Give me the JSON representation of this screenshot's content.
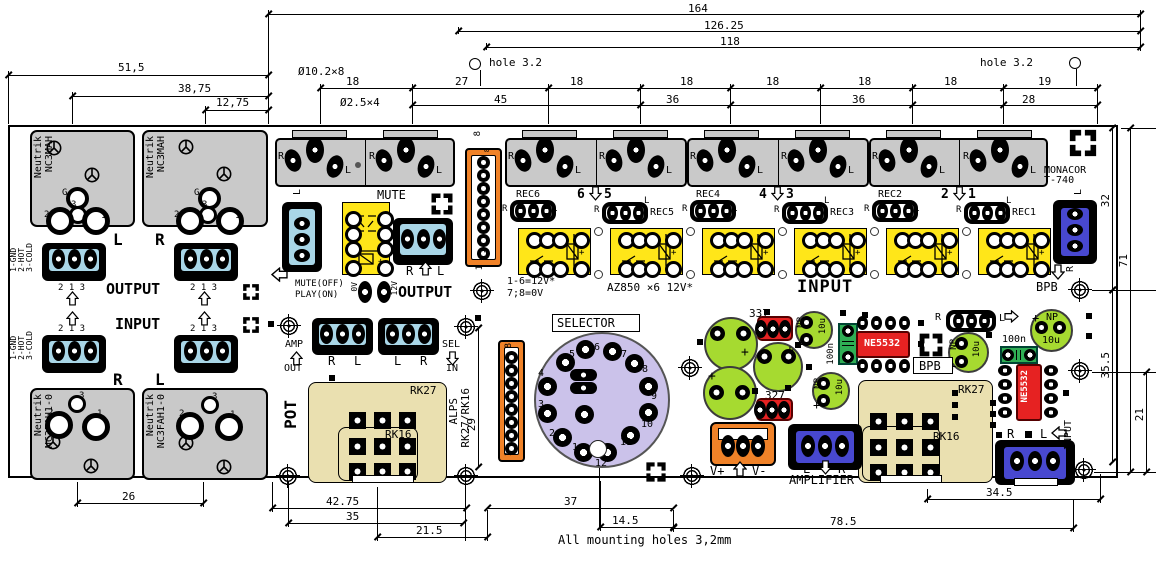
{
  "colors": {
    "gray": "#c9c9c9",
    "blue-light": "#a9d6e7",
    "blue-royal": "#4848d0",
    "orange": "#f08228",
    "yellow": "#ffe619",
    "tan": "#eae0b0",
    "lavender": "#cbc2ea",
    "green-cap": "#a6da30",
    "green-film": "#2fae54",
    "red": "#e62222"
  },
  "dims": {
    "w164": "164",
    "w12625": "126.25",
    "w118": "118",
    "hole": "hole 3.2",
    "dia1": "Ø10.2×8",
    "dia2": "Ø2.5×4",
    "s18": "18",
    "s27": "27",
    "s19": "19",
    "s45": "45",
    "s36": "36",
    "s28": "28",
    "l515": "51,5",
    "l3875": "38,75",
    "l1275": "12,75",
    "l26": "26",
    "r32": "32",
    "r71": "71",
    "r355": "35.5",
    "r21": "21",
    "p29": "29",
    "b4275": "42.75",
    "b35": "35",
    "b215": "21.5",
    "b37": "37",
    "b145": "14.5",
    "b785": "78.5",
    "b345": "34.5",
    "note": "All mounting holes 3,2mm"
  },
  "io": {
    "neutrik": "Neutrik",
    "nc3mah": "NC3MAH",
    "nc3fah": "NC3FAH1-0",
    "g": "G",
    "n1": "1",
    "n2": "2",
    "n3": "3",
    "l": "L",
    "r": "R",
    "output": "OUTPUT",
    "input": "INPUT",
    "pins": "2 1 3",
    "key": "1-GND\n2-HOT\n3-COLD"
  },
  "mute": {
    "name": "MUTE",
    "off": "MUTE(OFF)",
    "on": "PLAY(ON)",
    "v0": "0V",
    "v12": "12V",
    "output": "OUTPUT",
    "p8": "8",
    "p1": "1"
  },
  "sel": {
    "title": "SELECTOR",
    "dim": "16.75",
    "pins": [
      "1",
      "2",
      "3",
      "4",
      "5",
      "6",
      "7",
      "8",
      "9",
      "10",
      "11",
      "12"
    ]
  },
  "rec": {
    "labels": [
      "REC6",
      "REC5",
      "REC4",
      "REC3",
      "REC2",
      "REC1"
    ],
    "nums": [
      "6",
      "5",
      "4",
      "3",
      "2",
      "1"
    ],
    "sup1": "1-6=12V*",
    "sup2": "7;8=0V",
    "note": "AZ850 ×6 12V*",
    "input": "INPUT",
    "monacor": "MONACOR",
    "t740": "T-740",
    "bpb": "BPB"
  },
  "pot": {
    "title": "POT",
    "amp": "AMP",
    "out": "OUT",
    "sel": "SEL",
    "in": "IN",
    "alps": "ALPS",
    "alps2": "RK27/RK16",
    "rk27": "RK27",
    "rk16": "RK16"
  },
  "pwr": {
    "c337": "337",
    "c327": "327",
    "np": "NP",
    "u10": "10u",
    "n100": "100n",
    "ic": "NE5532",
    "vp": "V+",
    "vm": "V-",
    "amplifier": "AMPLIFIER"
  }
}
